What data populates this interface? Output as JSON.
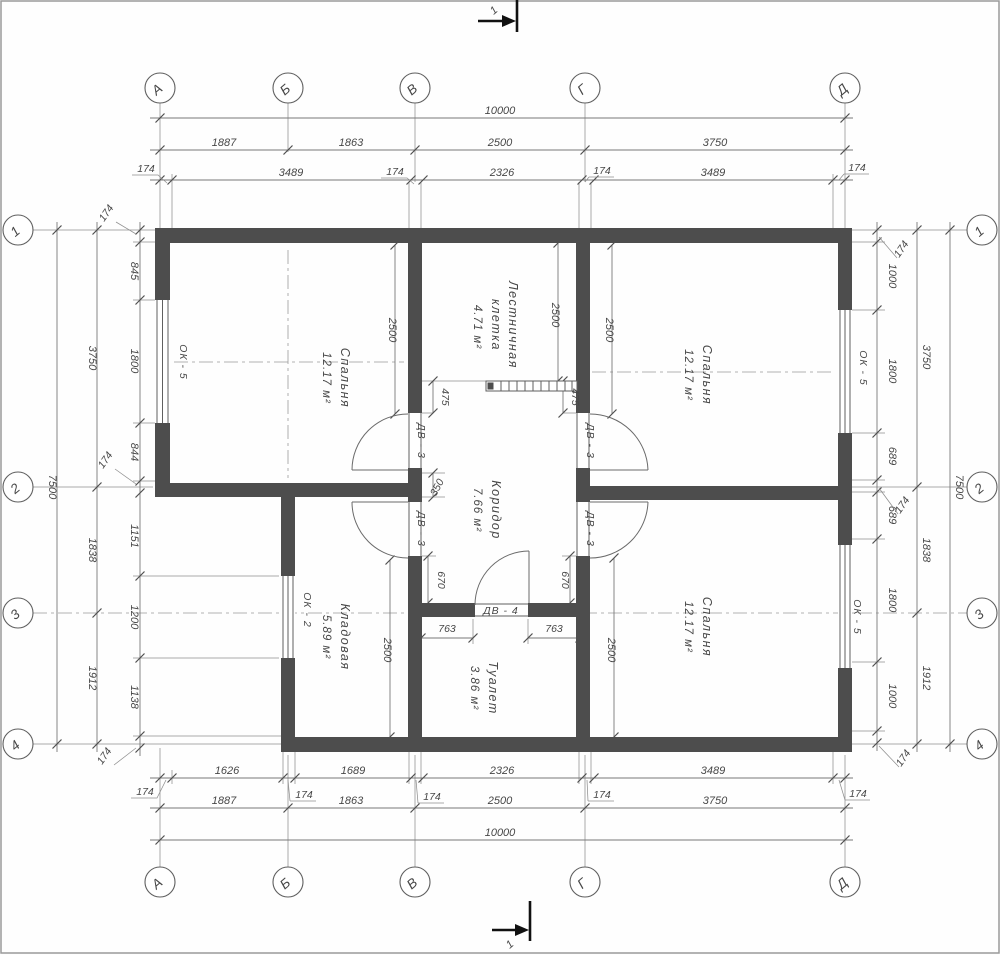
{
  "drawing": {
    "axis_columns": [
      "А",
      "Б",
      "В",
      "Г",
      "Д"
    ],
    "axis_rows": [
      "1",
      "2",
      "3",
      "4"
    ],
    "section_mark": "1",
    "rooms": {
      "bedroom_tl": {
        "name": "Спальня",
        "area": "12.17 м²"
      },
      "bedroom_tr": {
        "name": "Спальня",
        "area": "12.17 м²"
      },
      "bedroom_br": {
        "name": "Спальня",
        "area": "12.17 м²"
      },
      "staircase": {
        "name": "Лестничная",
        "name2": "клетка",
        "area": "4.71 м²"
      },
      "corridor": {
        "name": "Коридор",
        "area": "7.66 м²"
      },
      "storage": {
        "name": "Кладовая",
        "area": "5.89 м²"
      },
      "toilet": {
        "name": "Туалет",
        "area": "3.86 м²"
      }
    },
    "windows": {
      "left": "ОК - 5",
      "right_top": "ОК - 5",
      "right_bottom": "ОК - 5",
      "storage": "ОК - 2"
    },
    "doors": {
      "v_upper_left": "ДВ - 3",
      "v_lower_left": "ДВ - 3",
      "v_upper_right": "ДВ - 3",
      "v_lower_right": "ДВ - 3",
      "toilet": "ДВ - 4"
    },
    "dims": {
      "top": {
        "overall": "10000",
        "mid": [
          "1887",
          "1863",
          "2500",
          "3750"
        ],
        "inner": [
          "3489",
          "2326",
          "3489"
        ],
        "wall": "174"
      },
      "bottom": {
        "overall": "10000",
        "mid": [
          "1887",
          "1863",
          "2500",
          "3750"
        ],
        "inner": [
          "1626",
          "1689",
          "2326",
          "3489"
        ],
        "wall": "174"
      },
      "left": {
        "overall": "7500",
        "mid": [
          "3750",
          "1838",
          "1912"
        ],
        "inner": [
          "845",
          "1800",
          "844",
          "1151",
          "1200",
          "1138"
        ],
        "wall": "174"
      },
      "right": {
        "overall": "7500",
        "mid": [
          "3750",
          "1838",
          "1912"
        ],
        "inner": [
          "1000",
          "1800",
          "689",
          "689",
          "1800",
          "1000"
        ],
        "wall": "174"
      },
      "interior": {
        "d2500": "2500",
        "d475": "475",
        "d350": "350",
        "d670": "670",
        "d763": "763"
      }
    }
  }
}
